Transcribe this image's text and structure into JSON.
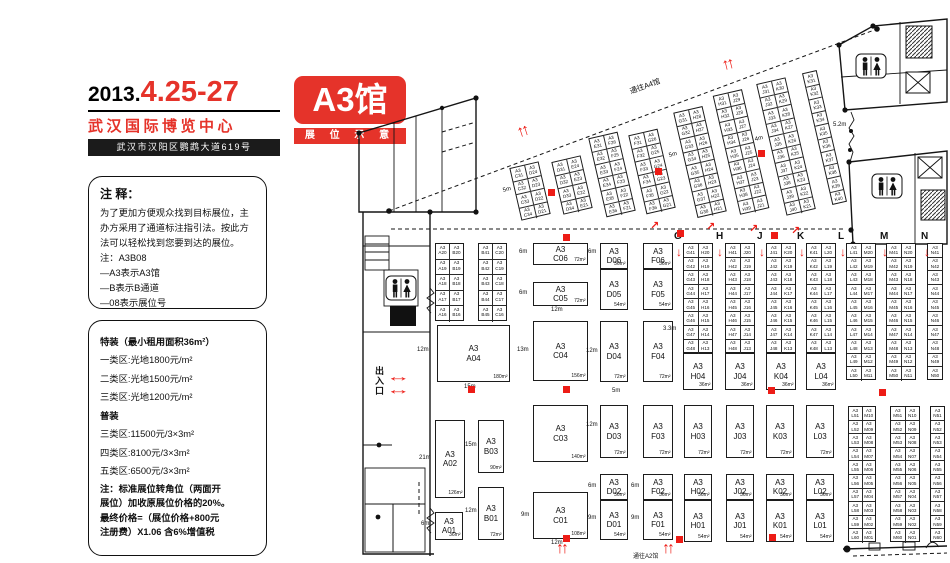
{
  "colors": {
    "red": "#e5332a",
    "arrow_red": "#ed1c16",
    "wall": "#151515"
  },
  "header": {
    "year": "2013.",
    "dates": "4.25-27",
    "venue": "武汉国际博览中心",
    "address": "武汉市汉阳区鹦鹉大道619号",
    "hall": "A3馆",
    "subtitle": "展 位 示 意 图"
  },
  "notes_panel": {
    "title": "注 释：",
    "body": "为了更加方便观众找到目标展位，主\n办方采用了通道标注指引法。按此方\n法可以轻松找到您要到达的展位。\n注：A3B08\n—A3表示A3馆\n—B表示B通道\n—08表示展位号"
  },
  "pricing_panel": {
    "lines": [
      {
        "t": "特装（最小租用面积36m²）",
        "b": 1
      },
      {
        "t": "一类区:光地1800元/m²",
        "b": 0
      },
      {
        "t": "二类区:光地1500元/m²",
        "b": 0
      },
      {
        "t": "三类区:光地1200元/m²",
        "b": 0
      },
      {
        "t": "普装",
        "b": 1
      },
      {
        "t": "三类区:11500元/3×3m²",
        "b": 0
      },
      {
        "t": "四类区:8100元/3×3m²",
        "b": 0
      },
      {
        "t": "五类区:6500元/3×3m²",
        "b": 0
      }
    ],
    "note": "注：标准展位转角位（两面开\n展位）加收原展位价格的20%。\n最终价格=（展位价格+800元\n注册费）X1.06 含6%增值税"
  },
  "plan": {
    "hall_prefix": "A3",
    "exit_label": "出入口",
    "booths": [
      {
        "c": "A04",
        "a": "180m²",
        "x": 437,
        "y": 325,
        "w": 73,
        "h": 57
      },
      {
        "c": "A02",
        "a": "126m²",
        "x": 435,
        "y": 420,
        "w": 30,
        "h": 78
      },
      {
        "c": "A01",
        "a": "36m²",
        "x": 435,
        "y": 512,
        "w": 28,
        "h": 28
      },
      {
        "c": "B03",
        "a": "90m²",
        "x": 478,
        "y": 420,
        "w": 26,
        "h": 53
      },
      {
        "c": "B01",
        "a": "72m²",
        "x": 478,
        "y": 487,
        "w": 26,
        "h": 53
      },
      {
        "c": "C06",
        "a": "72m²",
        "x": 533,
        "y": 243,
        "w": 55,
        "h": 22
      },
      {
        "c": "C05",
        "a": "72m²",
        "x": 533,
        "y": 282,
        "w": 55,
        "h": 24
      },
      {
        "c": "C04",
        "a": "156m²",
        "x": 533,
        "y": 321,
        "w": 55,
        "h": 60
      },
      {
        "c": "C03",
        "a": "140m²",
        "x": 533,
        "y": 405,
        "w": 55,
        "h": 57
      },
      {
        "c": "C01",
        "a": "108m²",
        "x": 533,
        "y": 492,
        "w": 55,
        "h": 47
      },
      {
        "c": "D06",
        "a": "36m²",
        "x": 600,
        "y": 243,
        "w": 28,
        "h": 26
      },
      {
        "c": "D05",
        "a": "54m²",
        "x": 600,
        "y": 269,
        "w": 28,
        "h": 41
      },
      {
        "c": "D04",
        "a": "72m²",
        "x": 600,
        "y": 321,
        "w": 28,
        "h": 61
      },
      {
        "c": "D03",
        "a": "72m²",
        "x": 600,
        "y": 405,
        "w": 28,
        "h": 53
      },
      {
        "c": "D02",
        "a": "36m²",
        "x": 600,
        "y": 474,
        "w": 28,
        "h": 26
      },
      {
        "c": "D01",
        "a": "54m²",
        "x": 600,
        "y": 500,
        "w": 28,
        "h": 40
      },
      {
        "c": "F06",
        "a": "36m²",
        "x": 643,
        "y": 243,
        "w": 30,
        "h": 26
      },
      {
        "c": "F05",
        "a": "54m²",
        "x": 643,
        "y": 269,
        "w": 30,
        "h": 41
      },
      {
        "c": "F04",
        "a": "72m²",
        "x": 643,
        "y": 321,
        "w": 30,
        "h": 61
      },
      {
        "c": "F03",
        "a": "72m²",
        "x": 643,
        "y": 405,
        "w": 30,
        "h": 53
      },
      {
        "c": "F02",
        "a": "36m²",
        "x": 643,
        "y": 474,
        "w": 30,
        "h": 26
      },
      {
        "c": "F01",
        "a": "54m²",
        "x": 643,
        "y": 500,
        "w": 30,
        "h": 40
      },
      {
        "c": "H04",
        "a": "36m²",
        "x": 683,
        "y": 353,
        "w": 30,
        "h": 37
      },
      {
        "c": "J04",
        "a": "36m²",
        "x": 725,
        "y": 353,
        "w": 30,
        "h": 37
      },
      {
        "c": "K04",
        "a": "36m²",
        "x": 766,
        "y": 353,
        "w": 30,
        "h": 37
      },
      {
        "c": "L04",
        "a": "36m²",
        "x": 806,
        "y": 353,
        "w": 30,
        "h": 37
      },
      {
        "c": "H03",
        "a": "72m²",
        "x": 684,
        "y": 405,
        "w": 28,
        "h": 53
      },
      {
        "c": "J03",
        "a": "72m²",
        "x": 726,
        "y": 405,
        "w": 28,
        "h": 53
      },
      {
        "c": "K03",
        "a": "72m²",
        "x": 766,
        "y": 405,
        "w": 28,
        "h": 53
      },
      {
        "c": "L03",
        "a": "72m²",
        "x": 806,
        "y": 405,
        "w": 28,
        "h": 53
      },
      {
        "c": "H02",
        "a": "36m²",
        "x": 684,
        "y": 474,
        "w": 28,
        "h": 26
      },
      {
        "c": "J02",
        "a": "36m²",
        "x": 726,
        "y": 474,
        "w": 28,
        "h": 26
      },
      {
        "c": "K02",
        "a": "36m²",
        "x": 766,
        "y": 474,
        "w": 28,
        "h": 26
      },
      {
        "c": "L02",
        "a": "36m²",
        "x": 806,
        "y": 474,
        "w": 28,
        "h": 26
      },
      {
        "c": "H01",
        "a": "54m²",
        "x": 684,
        "y": 500,
        "w": 28,
        "h": 42
      },
      {
        "c": "J01",
        "a": "54m²",
        "x": 726,
        "y": 500,
        "w": 28,
        "h": 42
      },
      {
        "c": "K01",
        "a": "54m²",
        "x": 766,
        "y": 500,
        "w": 28,
        "h": 42
      },
      {
        "c": "L01",
        "a": "54m²",
        "x": 806,
        "y": 500,
        "w": 28,
        "h": 42
      }
    ],
    "strips": [
      {
        "x": 435,
        "y": 243,
        "w": 29,
        "rh": 15.6,
        "rows": [
          "A20|B20",
          "A19|B19",
          "A18|B18",
          "A17|B17",
          "A16|B16"
        ]
      },
      {
        "x": 478,
        "y": 243,
        "w": 29,
        "rh": 15.6,
        "rows": [
          "B41|C20",
          "B42|C19",
          "B43|C18",
          "B44|C17",
          "B45|C16"
        ]
      },
      {
        "x": 683,
        "y": 243,
        "w": 30,
        "rh": 13.7,
        "rows": [
          "G41|H20",
          "G42|H19",
          "G43|H18",
          "G44|H17",
          "G45|H16",
          "G46|H15",
          "G47|H14",
          "G48|H13"
        ]
      },
      {
        "x": 725,
        "y": 243,
        "w": 30,
        "rh": 13.7,
        "rows": [
          "H41|J20",
          "H42|J19",
          "H43|J18",
          "H44|J17",
          "H45|J16",
          "H46|J15",
          "H47|J14",
          "H48|J13"
        ]
      },
      {
        "x": 766,
        "y": 243,
        "w": 30,
        "rh": 13.7,
        "rows": [
          "J41|K20",
          "J42|K19",
          "J43|K18",
          "J44|K17",
          "J45|K16",
          "J46|K15",
          "J47|K14",
          "J48|K13"
        ]
      },
      {
        "x": 806,
        "y": 243,
        "w": 30,
        "rh": 13.7,
        "rows": [
          "K41|L20",
          "K42|L19",
          "K43|L18",
          "K44|L17",
          "K45|L16",
          "K46|L15",
          "K47|L14",
          "K48|L13"
        ]
      },
      {
        "x": 846,
        "y": 243,
        "w": 30,
        "rh": 13.7,
        "rows": [
          "L41|M20",
          "L42|M19",
          "L43|M18",
          "L44|M17",
          "L45|M16",
          "L46|M15",
          "L47|M14",
          "L48|M13",
          "L49|M12",
          "L50|M11"
        ]
      },
      {
        "x": 886,
        "y": 243,
        "w": 30,
        "rh": 13.7,
        "rows": [
          "M41|N20",
          "M42|N19",
          "M43|N18",
          "M44|N17",
          "M45|N16",
          "M46|N15",
          "M47|N14",
          "M48|N13",
          "M49|N12",
          "M50|N11"
        ]
      },
      {
        "x": 927,
        "y": 243,
        "w": 16,
        "rh": 13.7,
        "rows": [
          "N41",
          "N42",
          "N43",
          "N44",
          "N45",
          "N46",
          "N47",
          "N48",
          "N49",
          "N50"
        ]
      },
      {
        "x": 848,
        "y": 406,
        "w": 28,
        "rh": 13.6,
        "rows": [
          "L51|M10",
          "L52|M09",
          "L53|M08",
          "L54|M07",
          "L55|M06",
          "L56|M05",
          "L57|M04",
          "L58|M03",
          "L59|M02",
          "L60|M01"
        ]
      },
      {
        "x": 890,
        "y": 406,
        "w": 30,
        "rh": 13.6,
        "rows": [
          "M51|N10",
          "M52|N09",
          "M53|N08",
          "M54|N07",
          "M55|N06",
          "M56|N05",
          "M57|N04",
          "M58|N03",
          "M59|N02",
          "M60|N01"
        ]
      },
      {
        "x": 930,
        "y": 406,
        "w": 15,
        "rh": 13.6,
        "rows": [
          "N51",
          "N52",
          "N53",
          "N54",
          "N55",
          "N56",
          "N57",
          "N58",
          "N59",
          "N60"
        ]
      }
    ],
    "diag_strips": [
      {
        "x": 515,
        "y": 164,
        "w": 30,
        "rh": 13.5,
        "rot": -13,
        "rows": [
          "C31|D24",
          "C32|D23",
          "C33|D22",
          "C34|D21"
        ]
      },
      {
        "x": 557,
        "y": 158,
        "w": 30,
        "rh": 13.5,
        "rot": -13,
        "rows": [
          "D31|E24",
          "D32|E23",
          "D33|E22",
          "D34|E21"
        ]
      },
      {
        "x": 597,
        "y": 134,
        "w": 30,
        "rh": 13.5,
        "rot": -13,
        "rows": [
          "E31|F26",
          "E32|F25",
          "E33|F24",
          "E34|F23",
          "E35|F22",
          "E36|F21"
        ]
      },
      {
        "x": 637,
        "y": 131,
        "w": 30,
        "rh": 13.5,
        "rot": -13,
        "rows": [
          "F31|G26",
          "F32|G25",
          "F33|G24",
          "F34|G23",
          "F35|G22",
          "F36|G21"
        ]
      },
      {
        "x": 685,
        "y": 108,
        "w": 30,
        "rh": 13.5,
        "rot": -13,
        "rows": [
          "G31|H28",
          "G32|H27",
          "G33|H26",
          "G34|H25",
          "G35|H24",
          "G36|H23",
          "G37|H22",
          "G38|H21"
        ]
      },
      {
        "x": 726,
        "y": 91,
        "w": 30,
        "rh": 13.5,
        "rot": -13,
        "rows": [
          "H31|J29",
          "H32|J28",
          "H33|J27",
          "H34|J26",
          "H35|J25",
          "H36|J24",
          "H37|J23",
          "H38|J22",
          "H39|J21"
        ]
      },
      {
        "x": 771,
        "y": 79,
        "w": 30,
        "rh": 13.5,
        "rot": -13,
        "rows": [
          "J31|K30",
          "J32|K29",
          "J33|K28",
          "J34|K27",
          "J35|K26",
          "J36|K25",
          "J37|K24",
          "J38|K23",
          "J39|K22",
          "J40|K21"
        ]
      },
      {
        "x": 817,
        "y": 70,
        "w": 15,
        "rh": 13.5,
        "rot": -13,
        "rows": [
          "K31",
          "K32",
          "K33",
          "K34",
          "K35",
          "K36",
          "K37",
          "K38",
          "K39",
          "K40"
        ]
      }
    ],
    "aisle_letters": [
      {
        "ch": "G",
        "x": 674
      },
      {
        "ch": "H",
        "x": 716
      },
      {
        "ch": "J",
        "x": 757
      },
      {
        "ch": "K",
        "x": 797
      },
      {
        "ch": "L",
        "x": 838
      },
      {
        "ch": "M",
        "x": 880
      },
      {
        "ch": "N",
        "x": 921
      }
    ],
    "letters_y": 231,
    "labels": [
      {
        "t": "12m",
        "x": 417,
        "y": 347
      },
      {
        "t": "15m",
        "x": 464,
        "y": 384
      },
      {
        "t": "21m",
        "x": 419,
        "y": 455
      },
      {
        "t": "6m",
        "x": 421,
        "y": 521
      },
      {
        "t": "15m",
        "x": 465,
        "y": 442
      },
      {
        "t": "12m",
        "x": 465,
        "y": 508
      },
      {
        "t": "6m",
        "x": 519,
        "y": 249
      },
      {
        "t": "6m",
        "x": 519,
        "y": 290
      },
      {
        "t": "12m",
        "x": 551,
        "y": 307
      },
      {
        "t": "13m",
        "x": 517,
        "y": 347
      },
      {
        "t": "9m",
        "x": 521,
        "y": 512
      },
      {
        "t": "12m",
        "x": 551,
        "y": 540
      },
      {
        "t": "6m",
        "x": 588,
        "y": 249
      },
      {
        "t": "12m",
        "x": 586,
        "y": 348
      },
      {
        "t": "12m",
        "x": 586,
        "y": 422
      },
      {
        "t": "6m",
        "x": 588,
        "y": 483
      },
      {
        "t": "9m",
        "x": 588,
        "y": 515
      },
      {
        "t": "6m",
        "x": 631,
        "y": 483
      },
      {
        "t": "9m",
        "x": 631,
        "y": 515
      },
      {
        "t": "5m",
        "x": 612,
        "y": 388
      },
      {
        "t": "3.3m",
        "x": 663,
        "y": 326
      },
      {
        "t": "5.2m",
        "x": 833,
        "y": 122
      },
      {
        "t": "5m",
        "x": 503,
        "y": 188,
        "r": -14
      },
      {
        "t": "5m",
        "x": 669,
        "y": 153,
        "r": -14
      },
      {
        "t": "4m",
        "x": 755,
        "y": 137,
        "r": -14
      },
      {
        "t": "通往A4馆",
        "x": 630,
        "y": 86,
        "r": -20,
        "big": 1
      },
      {
        "t": "通往A2馆",
        "x": 633,
        "y": 551
      }
    ],
    "pillars": [
      {
        "x": 548,
        "y": 189
      },
      {
        "x": 655,
        "y": 168
      },
      {
        "x": 758,
        "y": 150
      },
      {
        "x": 563,
        "y": 234
      },
      {
        "x": 677,
        "y": 230
      },
      {
        "x": 771,
        "y": 232
      },
      {
        "x": 468,
        "y": 386
      },
      {
        "x": 563,
        "y": 386
      },
      {
        "x": 768,
        "y": 387
      },
      {
        "x": 879,
        "y": 389
      },
      {
        "x": 563,
        "y": 535
      },
      {
        "x": 676,
        "y": 536
      },
      {
        "x": 769,
        "y": 534
      }
    ],
    "arrows": {
      "up_double": [
        {
          "x": 517,
          "y": 123,
          "r": -18
        },
        {
          "x": 722,
          "y": 56,
          "r": -14
        },
        {
          "x": 556,
          "y": 540,
          "r": 0
        },
        {
          "x": 662,
          "y": 540,
          "r": 0
        }
      ],
      "down": [
        {
          "x": 676,
          "y": 245
        },
        {
          "x": 717,
          "y": 245
        },
        {
          "x": 759,
          "y": 245
        },
        {
          "x": 799,
          "y": 245
        },
        {
          "x": 840,
          "y": 245
        },
        {
          "x": 882,
          "y": 245
        },
        {
          "x": 924,
          "y": 245
        }
      ],
      "diag": [
        {
          "x": 650,
          "y": 219
        },
        {
          "x": 706,
          "y": 220
        },
        {
          "x": 749,
          "y": 222
        },
        {
          "x": 791,
          "y": 224
        }
      ],
      "leftright": [
        {
          "x": 392,
          "y": 369
        },
        {
          "x": 392,
          "y": 382
        }
      ],
      "glyphs": {
        "up_double": "↑↑",
        "down": "↓",
        "diag": "↗",
        "leftright": "↔"
      }
    }
  }
}
